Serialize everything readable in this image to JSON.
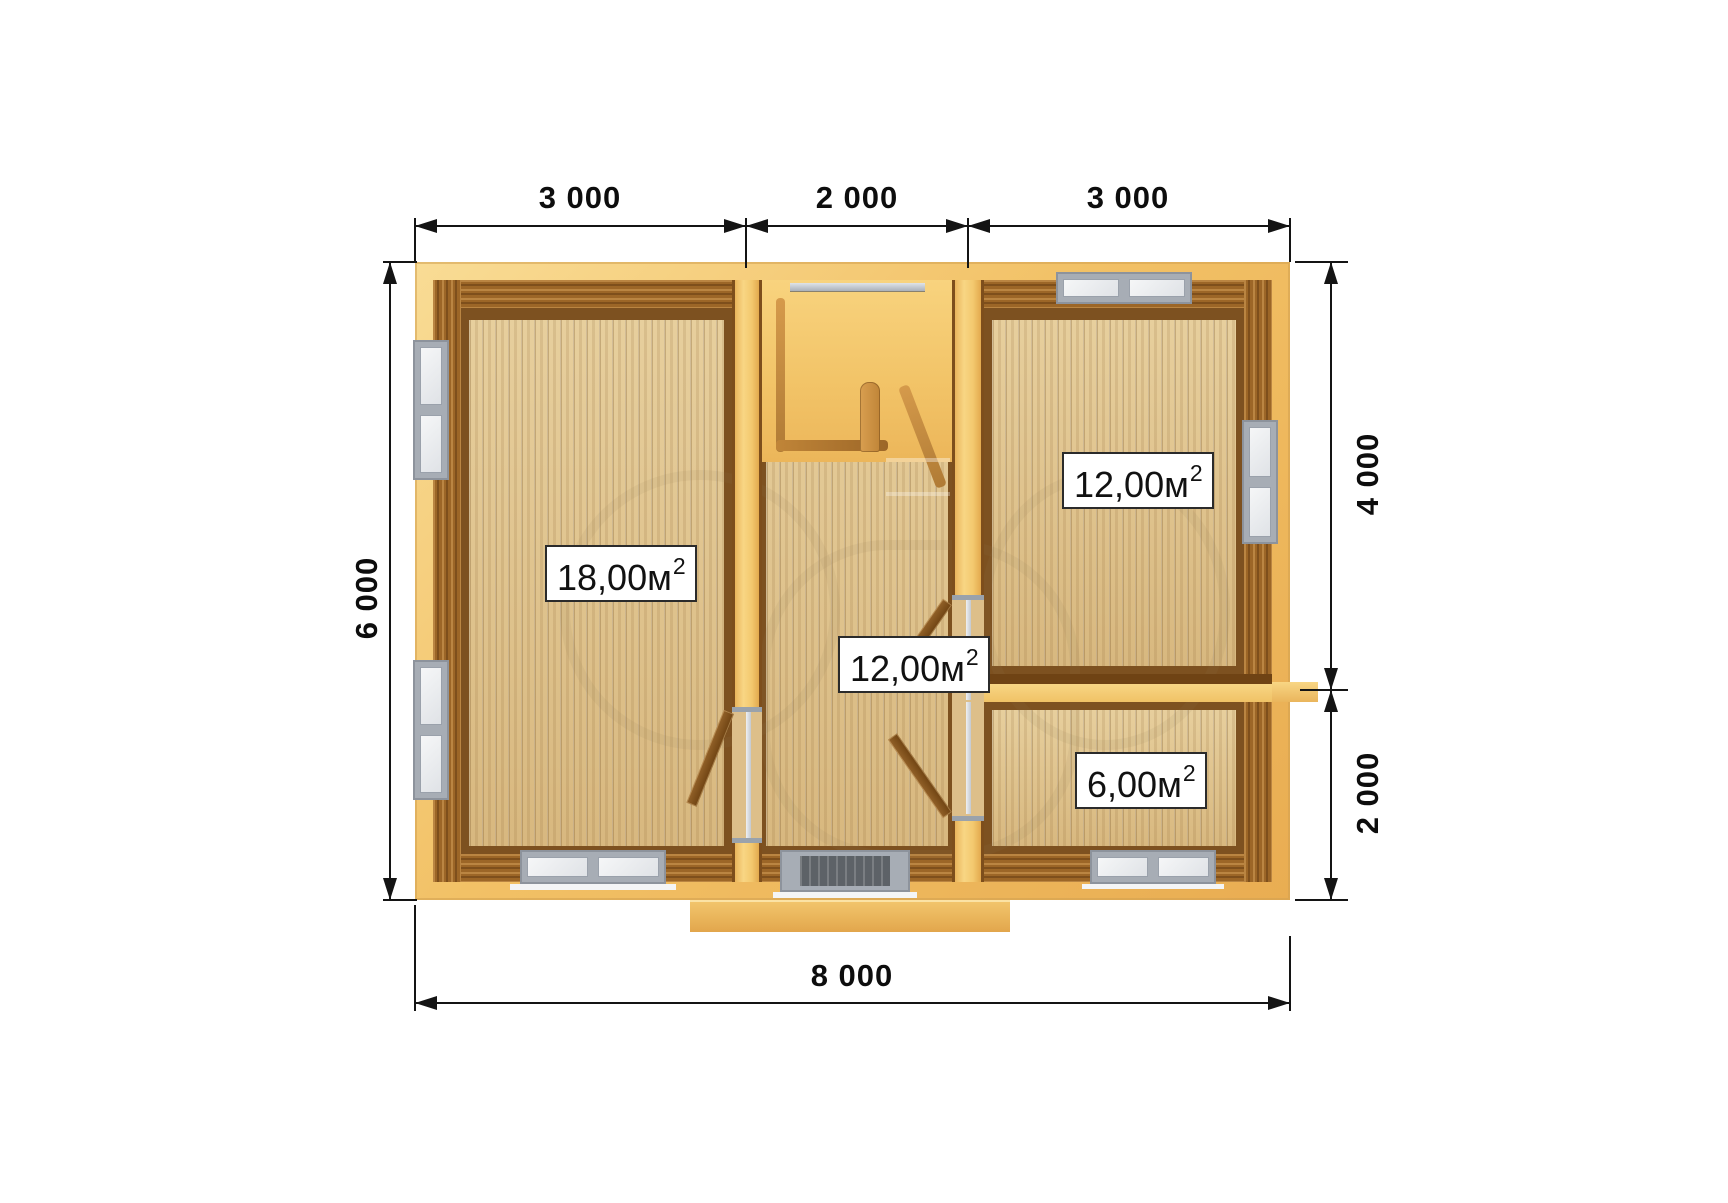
{
  "dimensions": {
    "top_segments": [
      {
        "label": "3 000"
      },
      {
        "label": "2 000"
      },
      {
        "label": "3 000"
      }
    ],
    "left": {
      "label": "6 000"
    },
    "right_segments": [
      {
        "label": "4 000"
      },
      {
        "label": "2 000"
      }
    ],
    "bottom": {
      "label": "8 000"
    }
  },
  "rooms": {
    "living": {
      "area": "18,00м",
      "sup": "2"
    },
    "hallway": {
      "area": "12,00м",
      "sup": "2"
    },
    "bedroom": {
      "area": "12,00м",
      "sup": "2"
    },
    "small": {
      "area": "6,00м",
      "sup": "2"
    }
  },
  "colors": {
    "wall_outer": "#f2c166",
    "wall_log": "#9c6627",
    "floor_plank": "#e0c48f",
    "terrace_floor": "#f2c468",
    "window_frame": "#a7adb5",
    "door_leaf": "#7e5020",
    "dimension_ink": "#141414",
    "background": "#ffffff"
  }
}
